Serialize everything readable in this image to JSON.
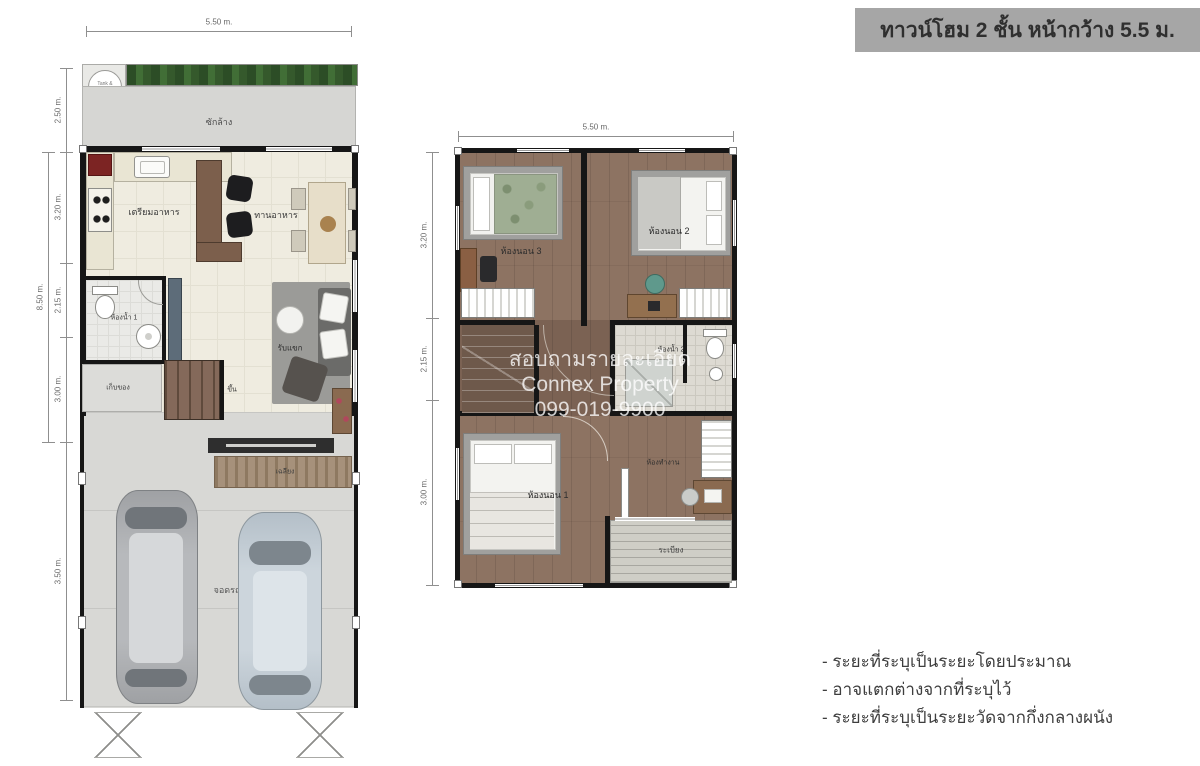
{
  "banner": {
    "text": "ทาวน์โฮม 2 ชั้น หน้ากว้าง 5.5 ม.",
    "bg": "#a6a6a6",
    "fg": "#2f2f2f"
  },
  "watermark": {
    "line1": "สอบถามรายละเอียด",
    "line2": "Connex Property",
    "line3": "099-019-9900"
  },
  "notes": {
    "line1": "- ระยะที่ระบุเป็นระยะโดยประมาณ",
    "line2": "- อาจแตกต่างจากที่ระบุไว้",
    "line3": "- ระยะที่ระบุเป็นระยะวัดจากกึ่งกลางผนัง"
  },
  "floor1": {
    "dim_top": "5.50 m.",
    "dim_laundry": "2.50 m.",
    "dim_total": "8.50 m.",
    "dim_seg1": "3.20 m.",
    "dim_seg2": "2.15 m.",
    "dim_seg3": "3.00 m.",
    "dim_garage": "3.50 m.",
    "labels": {
      "tank": "Tank & Pump",
      "laundry": "ซักล้าง",
      "kitchen": "เตรียมอาหาร",
      "dining": "ทานอาหาร",
      "bath1": "ห้องน้ำ 1",
      "storage": "เก็บของ",
      "up": "ขึ้น",
      "living": "รับแขก",
      "porch": "เฉลียง",
      "parking": "จอดรถ"
    }
  },
  "floor2": {
    "dim_top": "5.50 m.",
    "dim_seg1": "3.20 m.",
    "dim_seg2": "2.15 m.",
    "dim_seg3": "3.00 m.",
    "labels": {
      "bedroom3": "ห้องนอน 3",
      "bedroom2": "ห้องนอน 2",
      "bath2": "ห้องน้ำ 2",
      "bedroom1": "ห้องนอน 1",
      "workroom": "ห้องทำงาน",
      "balcony": "ระเบียง"
    }
  },
  "colors": {
    "banner_bg": "#a6a6a6",
    "floor1_floor": "#efece0",
    "garage_floor": "#d8d8d5",
    "laundry_floor": "#d6d6d3",
    "wood_floor": "#8d7362",
    "hedge_green": "#3a5a30",
    "wall_black": "#161616"
  }
}
